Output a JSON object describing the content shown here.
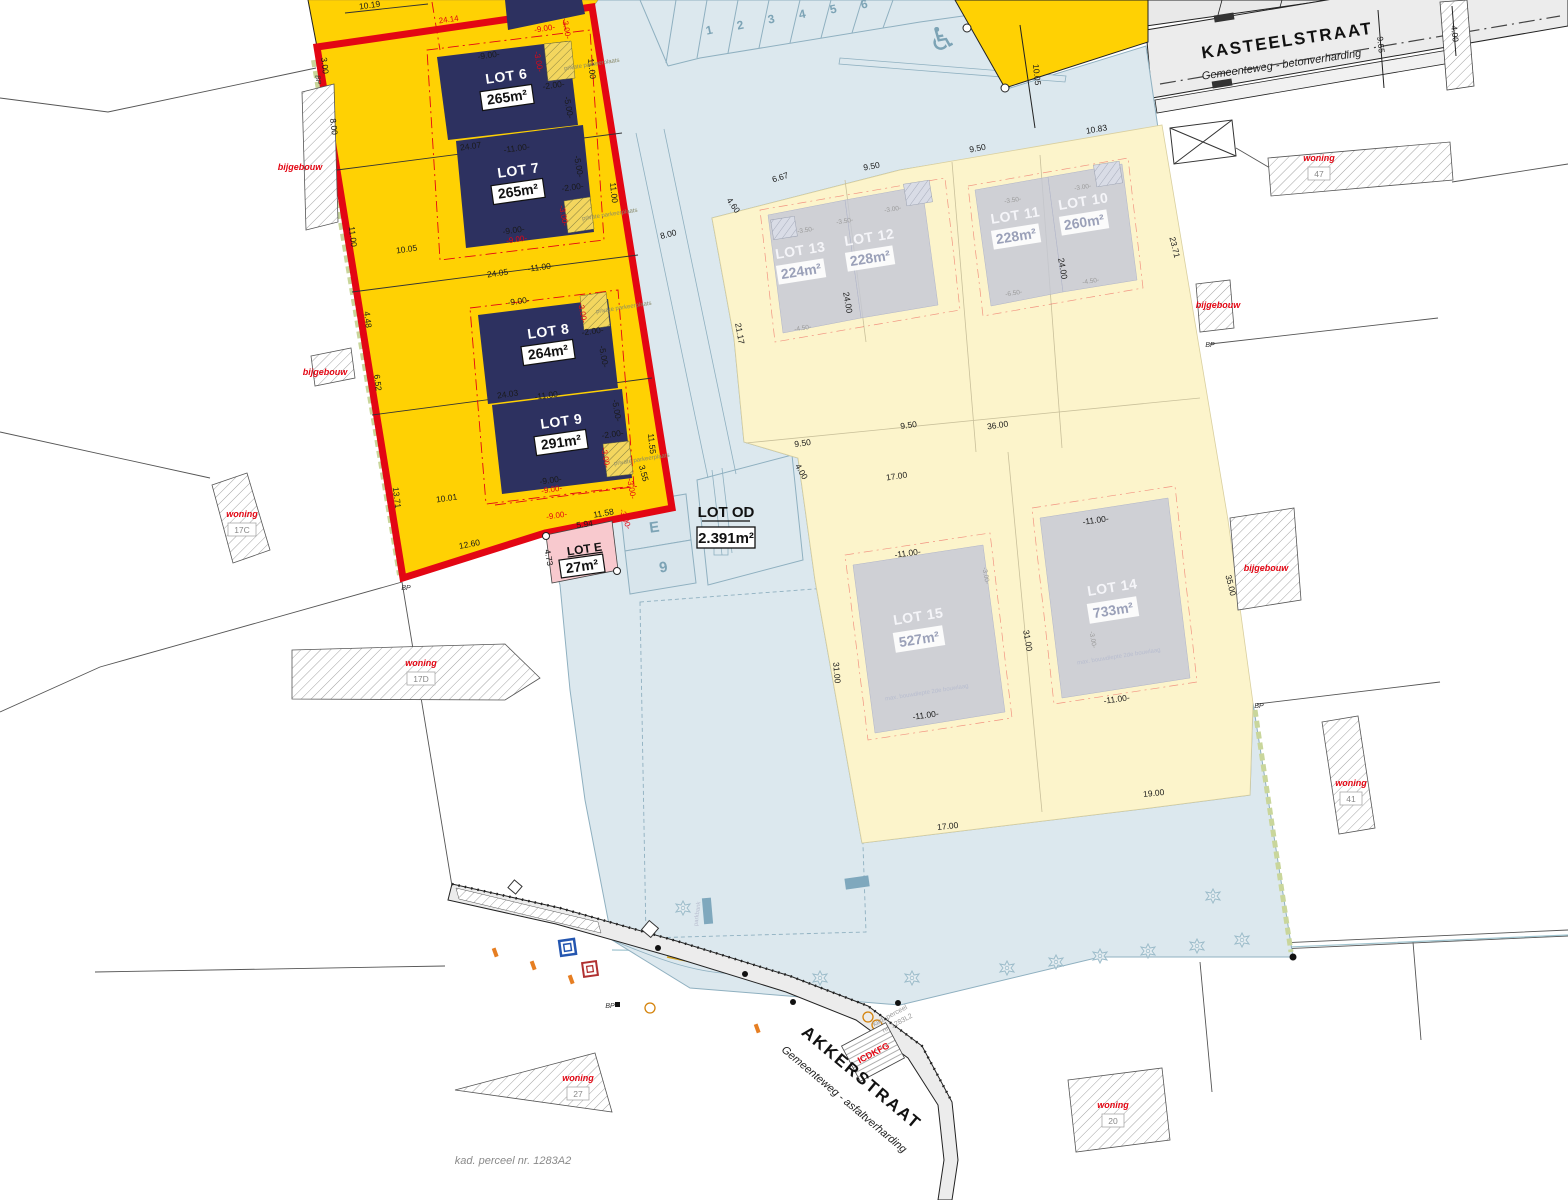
{
  "plan": {
    "kad_label": "kad. perceel nr. 1283A2",
    "kad2a": "kad. perceel",
    "kad2b": "nr. 1283L2",
    "icdkfg": "ICDKFG"
  },
  "streets": {
    "kasteelstraat": {
      "name": "KASTEELSTRAAT",
      "type": "Gemeenteweg - betonverharding"
    },
    "akkerstraat": {
      "name": "AKKERSTRAAT",
      "type": "Gemeenteweg - asfaltverharding"
    }
  },
  "lots": {
    "lot6": {
      "name": "LOT 6",
      "area": "265m²"
    },
    "lot7": {
      "name": "LOT 7",
      "area": "265m²"
    },
    "lot8": {
      "name": "LOT 8",
      "area": "264m²"
    },
    "lot9": {
      "name": "LOT 9",
      "area": "291m²"
    },
    "lotE": {
      "name": "LOT E",
      "area": "27m²"
    },
    "lotOD": {
      "name": "LOT OD",
      "area": "2.391m²"
    },
    "lot10": {
      "name": "LOT 10",
      "area": "260m²"
    },
    "lot11": {
      "name": "LOT 11",
      "area": "228m²"
    },
    "lot12": {
      "name": "LOT 12",
      "area": "228m²"
    },
    "lot13": {
      "name": "LOT 13",
      "area": "224m²"
    },
    "lot14": {
      "name": "LOT 14",
      "area": "733m²"
    },
    "lot15": {
      "name": "LOT 15",
      "area": "527m²"
    }
  },
  "labels": {
    "e": "E",
    "nine": "9",
    "bp": "BP",
    "disabled": "♿"
  },
  "parking": {
    "numbers": [
      {
        "t": "1",
        "x": 710,
        "y": 34
      },
      {
        "t": "2",
        "x": 741,
        "y": 29
      },
      {
        "t": "3",
        "x": 772,
        "y": 23
      },
      {
        "t": "4",
        "x": 803,
        "y": 18
      },
      {
        "t": "5",
        "x": 834,
        "y": 13
      },
      {
        "t": "6",
        "x": 865,
        "y": 8
      }
    ]
  },
  "parcels": [
    {
      "label": "woning",
      "num": "17C",
      "x": 242,
      "y": 517
    },
    {
      "label": "woning",
      "num": "17D",
      "x": 421,
      "y": 666
    },
    {
      "label": "woning",
      "num": "47",
      "x": 1319,
      "y": 161
    },
    {
      "label": "woning",
      "num": "41",
      "x": 1351,
      "y": 786
    },
    {
      "label": "woning",
      "num": "27",
      "x": 578,
      "y": 1081
    },
    {
      "label": "woning",
      "num": "20",
      "x": 1113,
      "y": 1108
    },
    {
      "label": "bijgebouw",
      "num": "",
      "x": 300,
      "y": 170
    },
    {
      "label": "bijgebouw",
      "num": "",
      "x": 325,
      "y": 375
    },
    {
      "label": "bijgebouw",
      "num": "",
      "x": 1218,
      "y": 308
    },
    {
      "label": "bijgebouw",
      "num": "",
      "x": 1266,
      "y": 571
    }
  ],
  "bp_markers": [
    {
      "x": 406,
      "y": 590,
      "r": 0
    },
    {
      "x": 316,
      "y": 80,
      "r": 83
    },
    {
      "x": 1210,
      "y": 347,
      "r": 0
    },
    {
      "x": 1259,
      "y": 708,
      "r": 0
    },
    {
      "x": 610,
      "y": 1008,
      "r": 0
    }
  ],
  "trees": [
    {
      "x": 683,
      "y": 908
    },
    {
      "x": 820,
      "y": 978
    },
    {
      "x": 912,
      "y": 978
    },
    {
      "x": 1007,
      "y": 968
    },
    {
      "x": 1056,
      "y": 962
    },
    {
      "x": 1100,
      "y": 956
    },
    {
      "x": 1148,
      "y": 951
    },
    {
      "x": 1197,
      "y": 946
    },
    {
      "x": 1242,
      "y": 940
    },
    {
      "x": 1213,
      "y": 896
    }
  ],
  "tiny_texts": [
    {
      "t": "private parkeerplaats",
      "x": 592,
      "y": 66,
      "r": -9,
      "c": "tt"
    },
    {
      "t": "private parkeerplaats",
      "x": 610,
      "y": 216,
      "r": -9,
      "c": "tt"
    },
    {
      "t": "private parkeerplaats",
      "x": 624,
      "y": 309,
      "r": -9,
      "c": "tt"
    },
    {
      "t": "private parkeerplaats",
      "x": 642,
      "y": 461,
      "r": -9,
      "c": "tt"
    },
    {
      "t": "max. bouwdiepte 2de bouwlaag",
      "x": 927,
      "y": 694,
      "r": -9,
      "c": "ttl"
    },
    {
      "t": "max. bouwdiepte 2de bouwlaag",
      "x": 1119,
      "y": 658,
      "r": -9,
      "c": "ttl"
    },
    {
      "t": "parkbank",
      "x": 699,
      "y": 914,
      "r": -83,
      "c": "ttl"
    }
  ],
  "dims": [
    {
      "t": "10.19",
      "x": 370,
      "y": 8,
      "r": -8,
      "c": "k"
    },
    {
      "t": "24.14",
      "x": 449,
      "y": 22,
      "r": -8,
      "c": "r"
    },
    {
      "t": "3.00",
      "x": 322,
      "y": 66,
      "r": 83,
      "c": "k"
    },
    {
      "t": "8.00",
      "x": 331,
      "y": 127,
      "r": 83,
      "c": "k"
    },
    {
      "t": "11.00",
      "x": 350,
      "y": 237,
      "r": 83,
      "c": "k"
    },
    {
      "t": "4.48",
      "x": 365,
      "y": 320,
      "r": 83,
      "c": "k"
    },
    {
      "t": "6.52",
      "x": 375,
      "y": 383,
      "r": 83,
      "c": "k"
    },
    {
      "t": "13.71",
      "x": 394,
      "y": 498,
      "r": 83,
      "c": "k"
    },
    {
      "t": "24.07",
      "x": 471,
      "y": 149,
      "r": -8,
      "c": "k"
    },
    {
      "t": "24.05",
      "x": 498,
      "y": 276,
      "r": -8,
      "c": "k"
    },
    {
      "t": "24.03",
      "x": 508,
      "y": 397,
      "r": -8,
      "c": "k"
    },
    {
      "t": "10.05",
      "x": 407,
      "y": 252,
      "r": -8,
      "c": "k"
    },
    {
      "t": "10.01",
      "x": 447,
      "y": 501,
      "r": -8,
      "c": "k"
    },
    {
      "t": "12.60",
      "x": 470,
      "y": 547,
      "r": -11,
      "c": "k"
    },
    {
      "t": "11.00",
      "x": 589,
      "y": 69,
      "r": 84,
      "c": "k"
    },
    {
      "t": "11.00",
      "x": 611,
      "y": 193,
      "r": 84,
      "c": "k"
    },
    {
      "t": "11.55",
      "x": 649,
      "y": 444,
      "r": 84,
      "c": "k"
    },
    {
      "t": "11.58",
      "x": 604,
      "y": 516,
      "r": -10,
      "c": "k"
    },
    {
      "t": "5.94",
      "x": 585,
      "y": 527,
      "r": -8,
      "c": "k"
    },
    {
      "t": "4.73",
      "x": 546,
      "y": 558,
      "r": 80,
      "c": "k"
    },
    {
      "t": "8.00",
      "x": 669,
      "y": 237,
      "r": -14,
      "c": "k"
    },
    {
      "t": "10.05",
      "x": 1034,
      "y": 75,
      "r": 84,
      "c": "k"
    },
    {
      "t": "9.50",
      "x": 978,
      "y": 151,
      "r": -10,
      "c": "k"
    },
    {
      "t": "10.83",
      "x": 1097,
      "y": 132,
      "r": -10,
      "c": "k"
    },
    {
      "t": "9.50",
      "x": 872,
      "y": 169,
      "r": -10,
      "c": "k"
    },
    {
      "t": "6.67",
      "x": 781,
      "y": 180,
      "r": -17,
      "c": "k"
    },
    {
      "t": "4.60",
      "x": 731,
      "y": 207,
      "r": 55,
      "c": "k"
    },
    {
      "t": "21.17",
      "x": 737,
      "y": 334,
      "r": 80,
      "c": "k"
    },
    {
      "t": "23.71",
      "x": 1172,
      "y": 248,
      "r": 76,
      "c": "k"
    },
    {
      "t": "24.00",
      "x": 845,
      "y": 303,
      "r": 80,
      "c": "k"
    },
    {
      "t": "24.00",
      "x": 1060,
      "y": 269,
      "r": 80,
      "c": "k"
    },
    {
      "t": "36.00",
      "x": 998,
      "y": 428,
      "r": -8,
      "c": "k"
    },
    {
      "t": "17.00",
      "x": 897,
      "y": 479,
      "r": -8,
      "c": "k"
    },
    {
      "t": "9.50",
      "x": 909,
      "y": 428,
      "r": -8,
      "c": "k"
    },
    {
      "t": "9.50",
      "x": 803,
      "y": 446,
      "r": -8,
      "c": "k"
    },
    {
      "t": "31.00",
      "x": 1025,
      "y": 641,
      "r": 80,
      "c": "k"
    },
    {
      "t": "31.00",
      "x": 834,
      "y": 673,
      "r": 85,
      "c": "k"
    },
    {
      "t": "35.00",
      "x": 1228,
      "y": 586,
      "r": 76,
      "c": "k"
    },
    {
      "t": "17.00",
      "x": 948,
      "y": 829,
      "r": -6,
      "c": "k"
    },
    {
      "t": "19.00",
      "x": 1154,
      "y": 796,
      "r": -6,
      "c": "k"
    },
    {
      "t": "4.00",
      "x": 799,
      "y": 473,
      "r": 60,
      "c": "k"
    },
    {
      "t": "9.65",
      "x": 1378,
      "y": 45,
      "r": 84,
      "c": "k"
    },
    {
      "t": "4.00",
      "x": 1452,
      "y": 34,
      "r": 84,
      "c": "k"
    },
    {
      "t": "-9.00-",
      "x": 489,
      "y": 58,
      "r": -8,
      "c": "k"
    },
    {
      "t": "-9.00-",
      "x": 545,
      "y": 31,
      "r": -8,
      "c": "r"
    },
    {
      "t": "-3.00-",
      "x": 564,
      "y": 29,
      "r": 80,
      "c": "r"
    },
    {
      "t": "-3.00-",
      "x": 536,
      "y": 62,
      "r": 80,
      "c": "r"
    },
    {
      "t": "-2.00-",
      "x": 554,
      "y": 88,
      "r": -8,
      "c": "k"
    },
    {
      "t": "-5.00-",
      "x": 566,
      "y": 108,
      "r": 80,
      "c": "k"
    },
    {
      "t": "-11.00-",
      "x": 517,
      "y": 151,
      "r": -8,
      "c": "k"
    },
    {
      "t": "-5.00-",
      "x": 576,
      "y": 167,
      "r": 80,
      "c": "k"
    },
    {
      "t": "-2.00-",
      "x": 573,
      "y": 190,
      "r": -8,
      "c": "k"
    },
    {
      "t": "-3.00-",
      "x": 561,
      "y": 216,
      "r": 80,
      "c": "r"
    },
    {
      "t": "-9.00-",
      "x": 514,
      "y": 233,
      "r": -8,
      "c": "k"
    },
    {
      "t": "-9.00-",
      "x": 517,
      "y": 242,
      "r": -8,
      "c": "r"
    },
    {
      "t": "-11.00-",
      "x": 541,
      "y": 270,
      "r": -8,
      "c": "k"
    },
    {
      "t": "-9.00-",
      "x": 519,
      "y": 304,
      "r": -8,
      "c": "k"
    },
    {
      "t": "-3.00-",
      "x": 580,
      "y": 313,
      "r": 80,
      "c": "r"
    },
    {
      "t": "-2.00-",
      "x": 593,
      "y": 334,
      "r": -8,
      "c": "k"
    },
    {
      "t": "-5.00-",
      "x": 601,
      "y": 357,
      "r": 80,
      "c": "k"
    },
    {
      "t": "-11.00-",
      "x": 548,
      "y": 398,
      "r": -8,
      "c": "k"
    },
    {
      "t": "-5.00-",
      "x": 614,
      "y": 411,
      "r": 80,
      "c": "k"
    },
    {
      "t": "-2.00-",
      "x": 613,
      "y": 437,
      "r": -8,
      "c": "k"
    },
    {
      "t": "-3.00-",
      "x": 603,
      "y": 458,
      "r": 80,
      "c": "r"
    },
    {
      "t": "-9.00-",
      "x": 551,
      "y": 483,
      "r": -8,
      "c": "k"
    },
    {
      "t": "-9.00-",
      "x": 552,
      "y": 492,
      "r": -8,
      "c": "r"
    },
    {
      "t": "-3.00-",
      "x": 629,
      "y": 489,
      "r": 80,
      "c": "r"
    },
    {
      "t": "-9.00-",
      "x": 557,
      "y": 518,
      "r": -8,
      "c": "r"
    },
    {
      "t": "-3.00-",
      "x": 623,
      "y": 520,
      "r": 70,
      "c": "r"
    },
    {
      "t": "3.55",
      "x": 641,
      "y": 474,
      "r": 75,
      "c": "k"
    },
    {
      "t": "-3.50-",
      "x": 806,
      "y": 232,
      "r": -9,
      "c": "g"
    },
    {
      "t": "-3.50-",
      "x": 845,
      "y": 223,
      "r": -9,
      "c": "g"
    },
    {
      "t": "-3.00-",
      "x": 893,
      "y": 211,
      "r": -9,
      "c": "g"
    },
    {
      "t": "-3.50-",
      "x": 1013,
      "y": 202,
      "r": -9,
      "c": "g"
    },
    {
      "t": "-3.00-",
      "x": 1083,
      "y": 189,
      "r": -9,
      "c": "g"
    },
    {
      "t": "-6.50-",
      "x": 1014,
      "y": 295,
      "r": -9,
      "c": "g"
    },
    {
      "t": "-4.50-",
      "x": 1091,
      "y": 283,
      "r": -9,
      "c": "g"
    },
    {
      "t": "-4.50-",
      "x": 803,
      "y": 330,
      "r": -9,
      "c": "g"
    },
    {
      "t": "-11.00-",
      "x": 908,
      "y": 556,
      "r": -8,
      "c": "k"
    },
    {
      "t": "-11.00-",
      "x": 926,
      "y": 718,
      "r": -8,
      "c": "k"
    },
    {
      "t": "-11.00-",
      "x": 1096,
      "y": 523,
      "r": -8,
      "c": "k"
    },
    {
      "t": "-11.00-",
      "x": 1117,
      "y": 702,
      "r": -8,
      "c": "k"
    },
    {
      "t": "-3.00-",
      "x": 1091,
      "y": 640,
      "r": 80,
      "c": "g"
    },
    {
      "t": "-3.00-",
      "x": 984,
      "y": 576,
      "r": 80,
      "c": "g"
    }
  ],
  "colors": {
    "zone_yellow": "#FFD103",
    "zone_red": "#E30613",
    "building_navy": "#2D3160",
    "zone_light_yellow": "#FCF4CB",
    "zone_blue": "#DCE8EE",
    "blue_line": "#8FB0C0",
    "road_gray": "#ECECEC",
    "lot_e_pink": "#F8C9CE",
    "building_gray": "#C3C7D7"
  }
}
